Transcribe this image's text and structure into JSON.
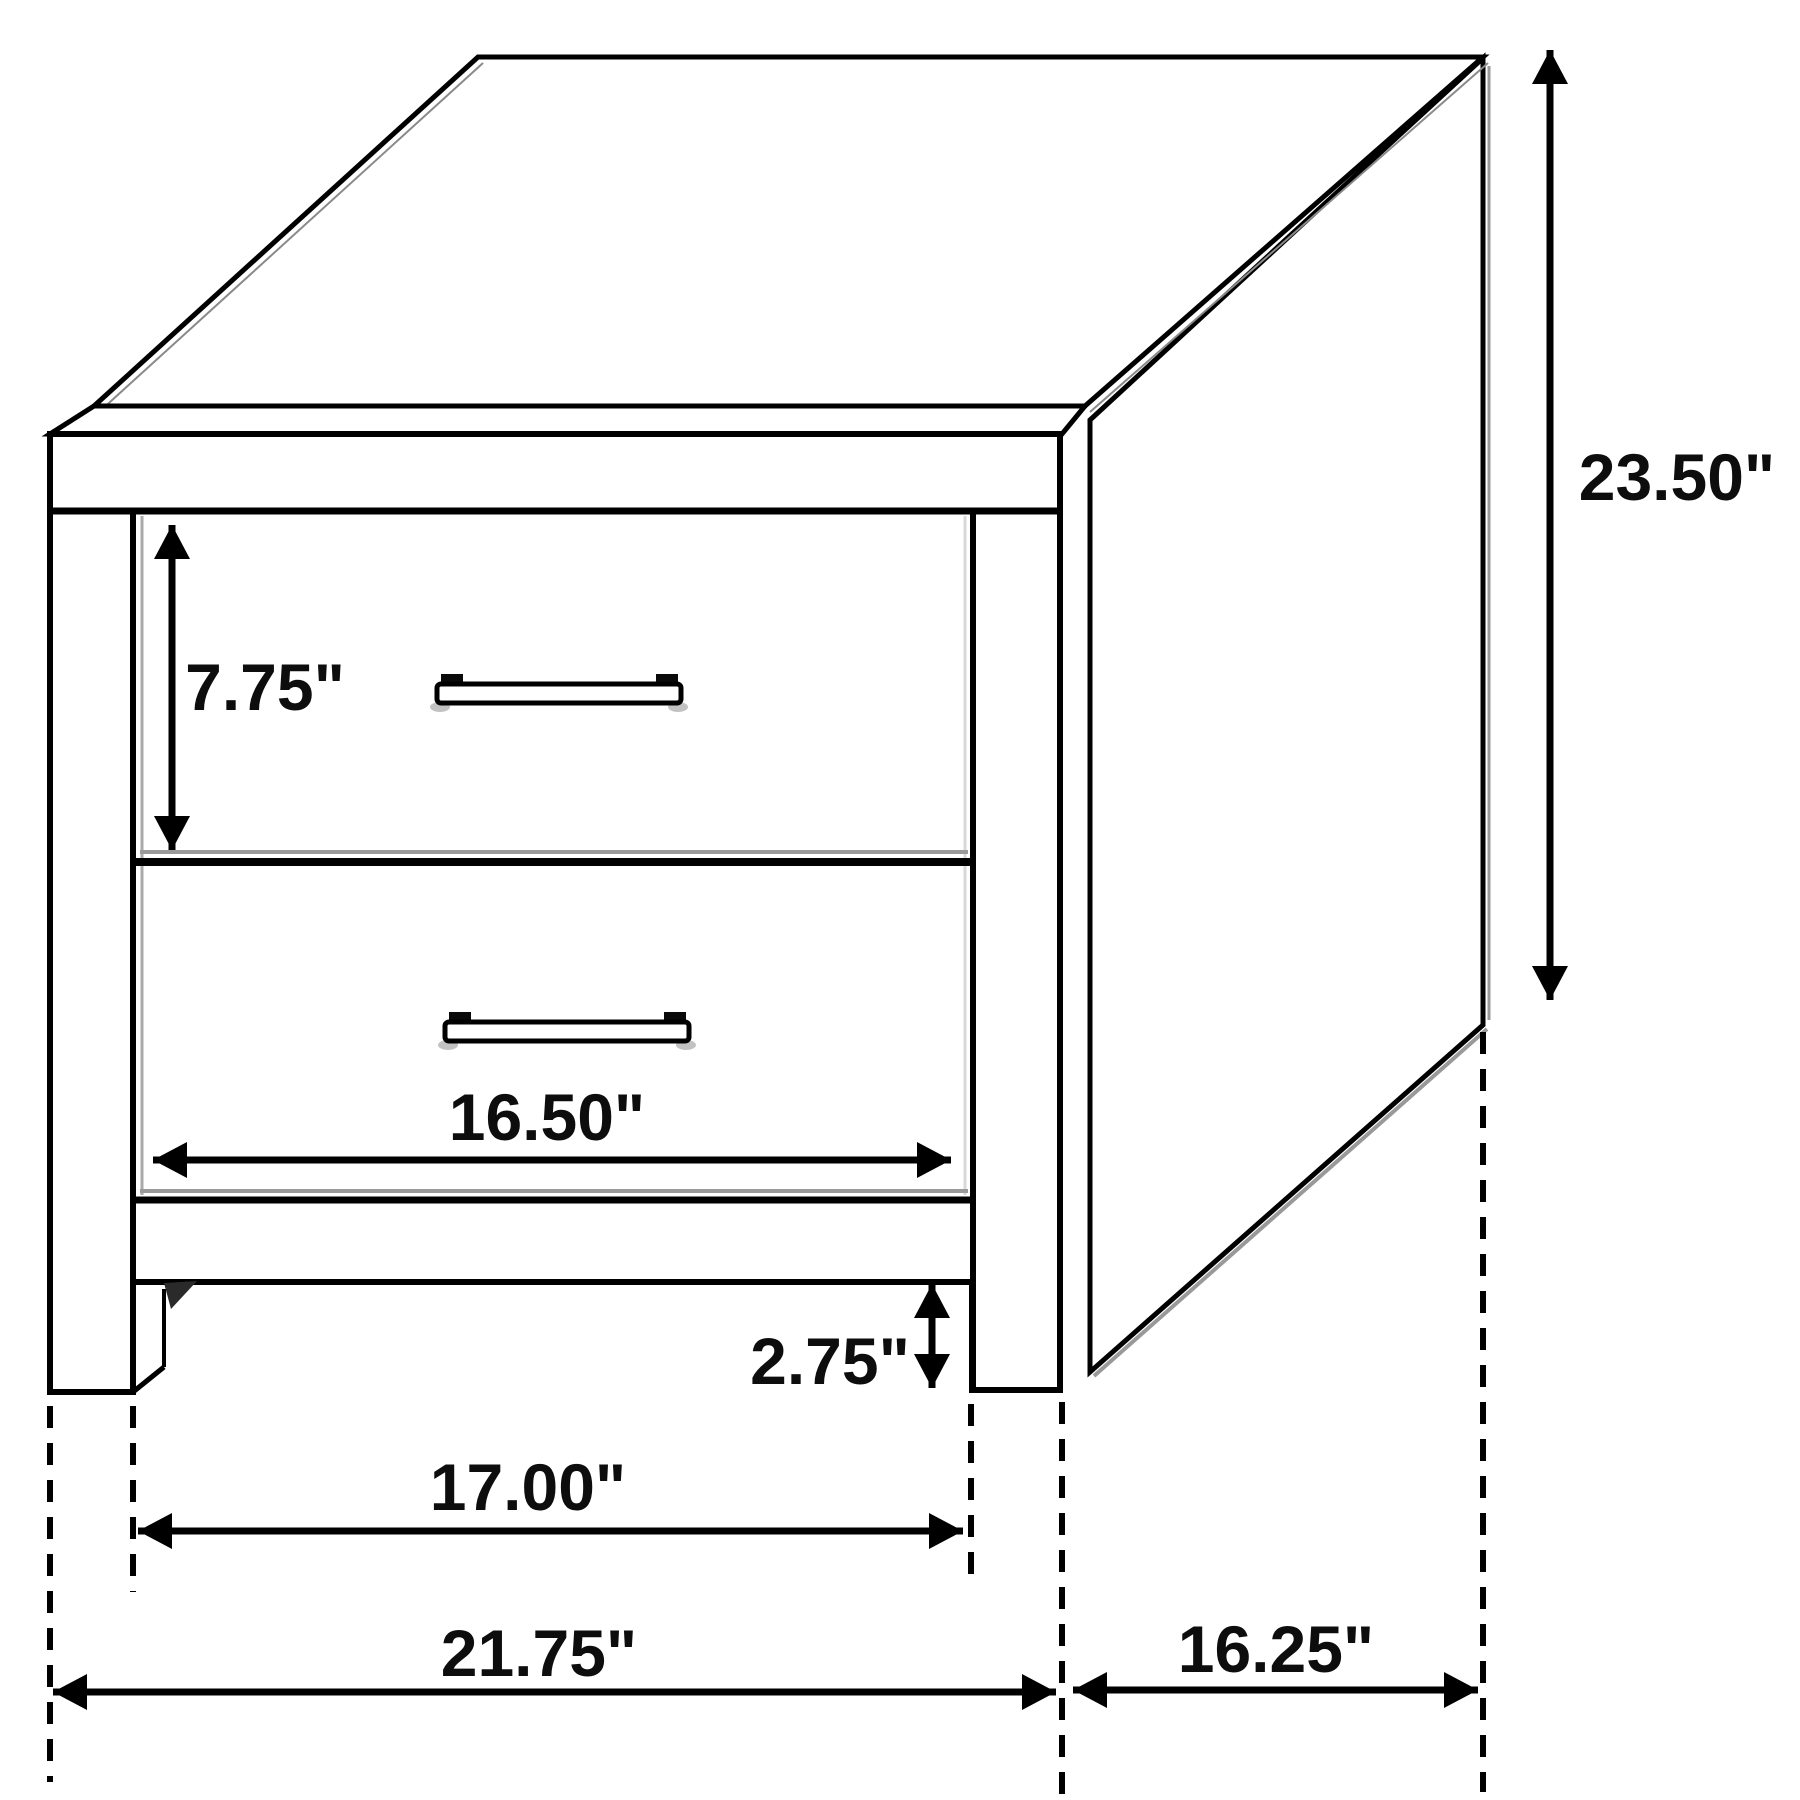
{
  "diagram": {
    "type": "furniture-dimension-diagram",
    "furniture": "two-drawer nightstand",
    "ink_color": "#000000",
    "background_color": "#ffffff",
    "labels": {
      "drawer_front_height": "7.75\"",
      "overall_height": "23.50\"",
      "drawer_width": "16.50\"",
      "leg_height": "2.75\"",
      "inner_footprint_width": "17.00\"",
      "overall_width": "21.75\"",
      "depth": "16.25\""
    }
  }
}
